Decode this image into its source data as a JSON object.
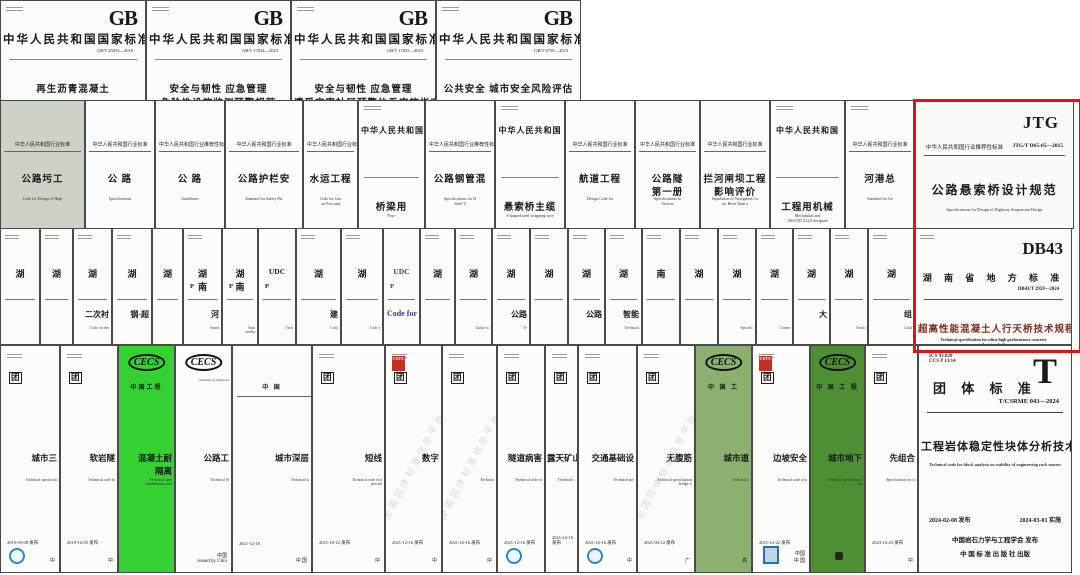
{
  "page": {
    "background": "#ffffff",
    "highlight_color": "#e01410"
  },
  "rows": [
    {
      "y": 0,
      "h": 101,
      "covers": [
        {
          "x": 0,
          "w": 146,
          "ics": 1,
          "logo": "GB",
          "header": "中华人民共和国国家标准",
          "code": "GB/T 25033—2010",
          "title": [
            "再生沥青混凝土"
          ]
        },
        {
          "x": 146,
          "w": 145,
          "ics": 1,
          "logo": "GB",
          "header": "中华人民共和国国家标准",
          "code": "GB/T 17034—2023",
          "title": [
            "安全与韧性  应急管理",
            "危险性设施监测预警规范"
          ]
        },
        {
          "x": 291,
          "w": 145,
          "ics": 1,
          "logo": "GB",
          "header": "中华人民共和国国家标准",
          "code": "GB/T 17035—2023",
          "title": [
            "安全与韧性  应急管理",
            "遭受灾害社区预警体系实施指南"
          ]
        },
        {
          "x": 436,
          "w": 145,
          "ics": 1,
          "logo": "GB",
          "header": "中华人民共和国国家标准",
          "code": "GB/T 6750—2023",
          "title": [
            "公共安全  城市安全风险评估"
          ]
        }
      ]
    },
    {
      "y": 100,
      "h": 129,
      "covers": [
        {
          "x": 0,
          "w": 85,
          "bg": "#ccd3c6",
          "header": "中华人民共和国行业标准",
          "title": [
            "公路圬工"
          ],
          "en": "Code for Design of High"
        },
        {
          "x": 85,
          "w": 70,
          "header": "中华人民共和国行业标准",
          "title": [
            "公  路"
          ],
          "en": "Specifications"
        },
        {
          "x": 155,
          "w": 70,
          "header": "中华人民共和国行业推荐性标准",
          "title": [
            "公  路"
          ],
          "en": "Guidelines"
        },
        {
          "x": 225,
          "w": 78,
          "header": "中华人民共和国行业标准",
          "title": [
            "公路护栏安"
          ],
          "en": "Standard for Safety Per"
        },
        {
          "x": 303,
          "w": 55,
          "header": "中华人民共和国行业标准",
          "title": [
            "水运工程"
          ],
          "en": "Code for Geo\non Port and"
        },
        {
          "x": 358,
          "w": 67,
          "cls": "tall",
          "ics": 1,
          "toprule": 1,
          "header": "中华人民共和国",
          "title": [
            "桥梁用"
          ],
          "en": "Post-"
        },
        {
          "x": 425,
          "w": 70,
          "header": "中华人民共和国行业推荐性标准",
          "title": [
            "公路钢管混"
          ],
          "en": "Specifications for D\nSteel T"
        },
        {
          "x": 495,
          "w": 70,
          "cls": "tall",
          "ics": 1,
          "toprule": 1,
          "header": "中华人民共和国",
          "title": [
            "悬索桥主缆"
          ],
          "en": "S-shaped steel wrapping wire"
        },
        {
          "x": 565,
          "w": 70,
          "header": "中华人民共和国行业标准",
          "title": [
            "航道工程"
          ],
          "en": "Design Code for"
        },
        {
          "x": 635,
          "w": 65,
          "header": "中华人民共和国行业标准",
          "title": [
            "公路隧",
            "第一册"
          ],
          "en": "Specifications fo\nSection"
        },
        {
          "x": 700,
          "w": 70,
          "header": "中华人民共和国行业标准",
          "title": [
            "拦河闸坝工程",
            "影响评价"
          ],
          "en": "Stipulation of Navigation Co\nfor River Dam a"
        },
        {
          "x": 770,
          "w": 75,
          "cls": "tall",
          "ics": 1,
          "toprule": 1,
          "header": "中华人民共和国",
          "title": [
            "工程用机械"
          ],
          "en": "Mechanical and\n(ISO/CD 2122) designed"
        },
        {
          "x": 845,
          "w": 70,
          "ics": 1,
          "header": "中华人民共和国行业标准",
          "title": [
            "河港总"
          ],
          "en": "Standard for Ge"
        },
        {
          "x": 915,
          "w": 159,
          "cls": "jtg",
          "logo": "JTG",
          "header": "中华人民共和国行业推荐性标准",
          "code": "JTG/T D65-05—2015",
          "title": [
            "公路悬索桥设计规范"
          ],
          "en": "Specifications for Design of Highway Suspension Bridge"
        }
      ]
    },
    {
      "y": 228,
      "h": 117,
      "covers": [
        {
          "x": 0,
          "w": 40,
          "strip": 1,
          "ics": 1,
          "big": "湖"
        },
        {
          "x": 40,
          "w": 33,
          "strip": 1,
          "ics": 1,
          "big": "湖"
        },
        {
          "x": 73,
          "w": 39,
          "strip": 1,
          "ics": 1,
          "big": "湖",
          "frag": "二次衬",
          "frag_en": "Code for des"
        },
        {
          "x": 112,
          "w": 40,
          "strip": 1,
          "ics": 1,
          "big": "湖",
          "frag": "钢-超"
        },
        {
          "x": 152,
          "w": 31,
          "strip": 1,
          "big": "湖"
        },
        {
          "x": 183,
          "w": 39,
          "strip": 1,
          "ics": 1,
          "big": "湖南",
          "sub": "P",
          "frag": "河",
          "frag_en": "Stand"
        },
        {
          "x": 222,
          "w": 36,
          "strip": 1,
          "big": "湖南",
          "sub": "P",
          "frag_en": "Stan\nmediu"
        },
        {
          "x": 258,
          "w": 38,
          "strip": 1,
          "big": "UDC",
          "sub": "P",
          "frag_en": "Tech"
        },
        {
          "x": 296,
          "w": 45,
          "strip": 1,
          "ics": 1,
          "big": "湖",
          "frag": "建",
          "frag_en": "Cons"
        },
        {
          "x": 341,
          "w": 42,
          "strip": 1,
          "ics": 1,
          "big": "湖",
          "frag_en": "Code f"
        },
        {
          "x": 383,
          "w": 37,
          "strip": 1,
          "blue": 1,
          "big": "UDC",
          "sub": "P",
          "frag": "Code for"
        },
        {
          "x": 420,
          "w": 35,
          "strip": 1,
          "ics": 1,
          "big": "湖"
        },
        {
          "x": 455,
          "w": 37,
          "strip": 1,
          "ics": 1,
          "big": "湖",
          "frag_en": "Guide fo"
        },
        {
          "x": 492,
          "w": 38,
          "strip": 1,
          "ics": 1,
          "big": "湖",
          "frag": "公路",
          "frag_en": "Te"
        },
        {
          "x": 530,
          "w": 38,
          "strip": 1,
          "ics": 1,
          "big": "湖"
        },
        {
          "x": 568,
          "w": 37,
          "strip": 1,
          "ics": 1,
          "big": "湖",
          "frag": "公路"
        },
        {
          "x": 605,
          "w": 37,
          "strip": 1,
          "ics": 1,
          "big": "湖",
          "frag": "智能",
          "frag_en": "Technical"
        },
        {
          "x": 642,
          "w": 38,
          "strip": 1,
          "ics": 1,
          "big": "南"
        },
        {
          "x": 680,
          "w": 38,
          "strip": 1,
          "ics": 1,
          "big": "湖"
        },
        {
          "x": 718,
          "w": 38,
          "strip": 1,
          "ics": 1,
          "big": "湖",
          "frag_en": "Specific"
        },
        {
          "x": 756,
          "w": 37,
          "strip": 1,
          "ics": 1,
          "big": "湖",
          "frag_en": "Comm"
        },
        {
          "x": 793,
          "w": 37,
          "strip": 1,
          "ics": 1,
          "big": "湖",
          "frag": "大"
        },
        {
          "x": 830,
          "w": 38,
          "strip": 1,
          "ics": 1,
          "big": "湖",
          "frag_en": "Techn"
        },
        {
          "x": 868,
          "w": 47,
          "strip": 1,
          "ics": 1,
          "big": "湖",
          "frag": "组",
          "frag_en": "Guid"
        },
        {
          "x": 915,
          "w": 157,
          "cls": "db43",
          "ics": 1,
          "logo": "DB43",
          "header": "湖 南 省 地 方 标 准",
          "code": "DB43/T 2959—2024",
          "maroon": 1,
          "title": [
            "超高性能混凝土人行天桥技术规程"
          ],
          "en": "Technical specification for ultra-high performance concrete\npedestrian bridge"
        }
      ]
    },
    {
      "y": 345,
      "h": 228,
      "covers": [
        {
          "x": 0,
          "w": 60,
          "ics": 1,
          "badge": "团",
          "title": [
            "城市三"
          ],
          "en": "Technical specificati",
          "date": "2019-03-08 发布",
          "emblem": "blue",
          "footer": "中"
        },
        {
          "x": 60,
          "w": 58,
          "ics": 1,
          "badge": "团",
          "title": [
            "软岩隧"
          ],
          "en": "Technical code fo",
          "date": "2019-12-05 发布",
          "footer": "中"
        },
        {
          "x": 118,
          "w": 57,
          "bg": "#35d133",
          "logo": "CECS",
          "org": "中国工程",
          "title": [
            "混凝土耐",
            "隔离"
          ],
          "en": "Technical spec\nrehabilitation and"
        },
        {
          "x": 175,
          "w": 57,
          "logo": "CECS",
          "org_sub": "Standard of China As",
          "title": [
            "公路工"
          ],
          "en": "Technical St",
          "footer": "中国\nissued by Chin"
        },
        {
          "x": 232,
          "w": 80,
          "org": "中  国",
          "toprule": 1,
          "title": [
            "城市深层"
          ],
          "en": "Technical st",
          "date": "2021-12-16",
          "footer": "中 国"
        },
        {
          "x": 312,
          "w": 73,
          "ics": 1,
          "badge": "团",
          "title": [
            "短线"
          ],
          "en": "Technical code of p\nprecast",
          "date": "2021-10-12 发布",
          "footer": "中"
        },
        {
          "x": 385,
          "w": 57,
          "ics": 1,
          "seal": "CSTC",
          "badge": "团",
          "title": [
            "数字"
          ],
          "date": "2021-12-16 发布",
          "watermark": "全国团体标准信息平台",
          "footer": "中"
        },
        {
          "x": 442,
          "w": 55,
          "ics": 1,
          "badge": "团",
          "en": "Technica",
          "date": "2021-12-16 发布",
          "watermark": "全国团体标准信息平台",
          "footer": "中"
        },
        {
          "x": 497,
          "w": 48,
          "ics": 1,
          "badge": "团",
          "title": [
            "隧道病害"
          ],
          "en": "Technical code of",
          "date": "2021-12-16 发布",
          "emblem": "blue"
        },
        {
          "x": 545,
          "w": 33,
          "ics": 1,
          "badge": "团",
          "title": [
            "露天矿山"
          ],
          "en": "Technical c",
          "date": "2021-12-16 发布"
        },
        {
          "x": 578,
          "w": 59,
          "ics": 1,
          "badge": "团",
          "title": [
            "交通基础设"
          ],
          "en": "Technical spe",
          "date": "2021-12-16 发布",
          "emblem": "blue",
          "footer": "中"
        },
        {
          "x": 637,
          "w": 58,
          "ics": 1,
          "badge": "团",
          "title": [
            "无腹筋"
          ],
          "en": "Technical specification\nbridge w",
          "date": "2021-04-12 发布",
          "watermark": "全国团体标准信息平台",
          "footer": "广"
        },
        {
          "x": 695,
          "w": 57,
          "bg": "#8cb070",
          "logo": "CECS",
          "org": "中 国 工",
          "title": [
            "城市道"
          ],
          "en": "Technical s",
          "footer": "高"
        },
        {
          "x": 752,
          "w": 58,
          "ics": 1,
          "seal": "CSTC",
          "badge": "团",
          "title": [
            "边坡安全"
          ],
          "en": "Technical code of p",
          "date": "2021-12-22 发布",
          "emblem": "frame",
          "footer": "中国\n中 国"
        },
        {
          "x": 810,
          "w": 55,
          "bg": "#4f8f33",
          "logo": "CECS",
          "org": "中 国 工 程",
          "title": [
            "城市地下"
          ],
          "en": "Technical specification\nwit",
          "emblem": "dark"
        },
        {
          "x": 865,
          "w": 53,
          "ics": 1,
          "badge": "团",
          "title": [
            "先组合"
          ],
          "en": "Specification for st",
          "date": "2023-12-25 发布",
          "footer": "中"
        },
        {
          "x": 918,
          "w": 154,
          "cls": "tcov",
          "logo": "T",
          "ics_text": "ICS 93.020\nCCS P 13/14",
          "header": "团 体 标 准",
          "code": "T/CSRME 043—2024",
          "title": [
            "工程岩体稳定性块体分析技术规范"
          ],
          "en": "Technical code for block analysis on stability of engineering rock masses",
          "date": "2024-02-08 发布",
          "date2": "2024-03-01 实施",
          "footer": "中国岩石力学与工程学会  发布",
          "footer2": "中 国 标 准 出 版 社  出版"
        }
      ]
    }
  ],
  "highlight": {
    "x": 913,
    "y": 99,
    "w": 163,
    "h": 248
  }
}
